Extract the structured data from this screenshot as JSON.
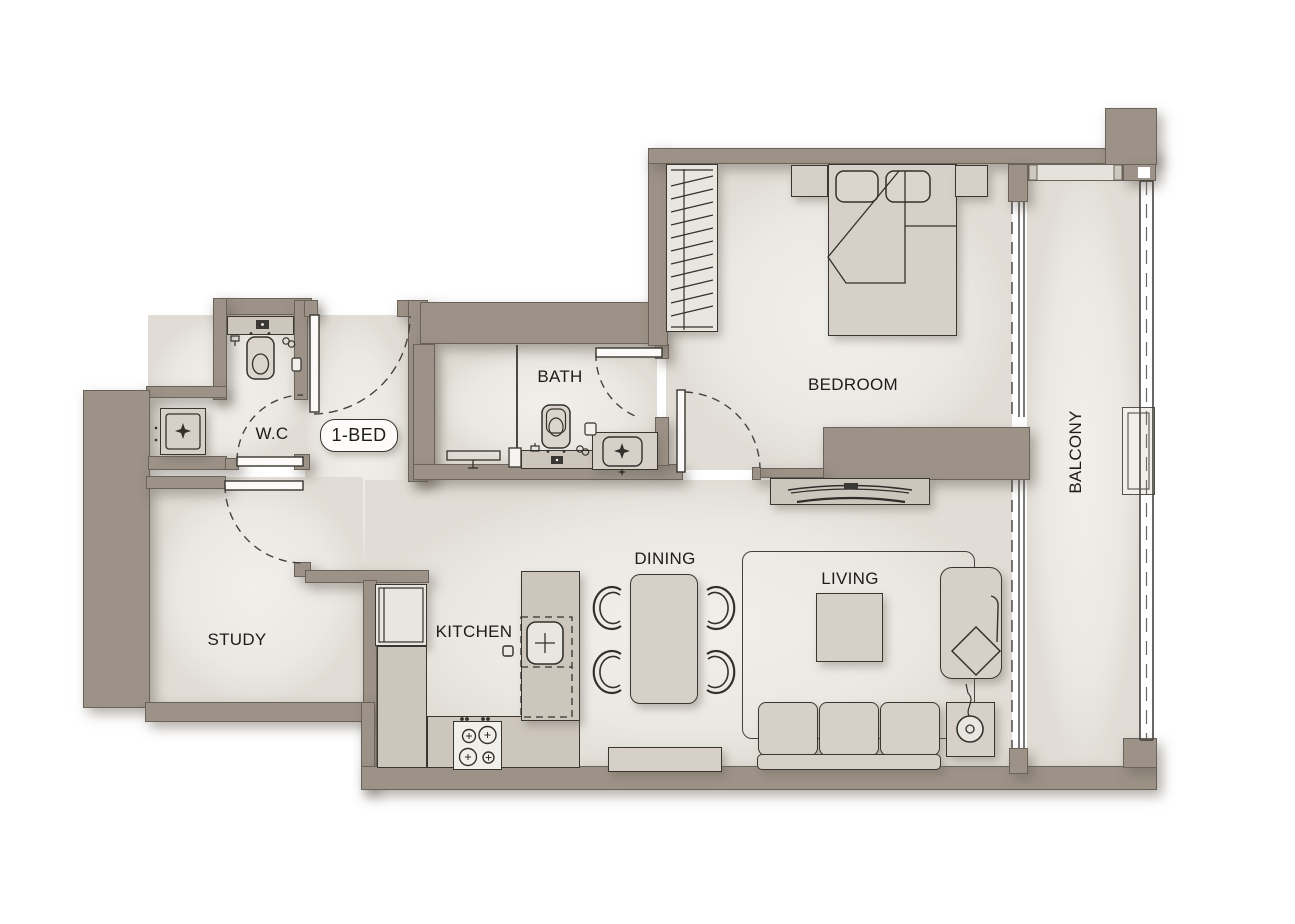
{
  "unit": {
    "label": "1-BED"
  },
  "rooms": {
    "wc": {
      "label": "W.C"
    },
    "bath": {
      "label": "BATH"
    },
    "bedroom": {
      "label": "BEDROOM"
    },
    "balcony": {
      "label": "BALCONY"
    },
    "study": {
      "label": "STUDY"
    },
    "kitchen": {
      "label": "KITCHEN"
    },
    "dining": {
      "label": "DINING"
    },
    "living": {
      "label": "LIVING"
    }
  },
  "colors": {
    "wall": "#9c9287",
    "wall_outline": "#6a635a",
    "floor": "#ebe8e3",
    "furniture": "#d6d0c8",
    "counter": "#cdc6bd",
    "outline": "#39362f",
    "background": "#ffffff",
    "text": "#1d1c1a"
  },
  "furniture_icons": [
    "double-bed",
    "pillow",
    "blanket-fold",
    "wardrobe-hangers",
    "nightstand",
    "tv-wall",
    "tv-console",
    "toilet",
    "washbasin",
    "vanity-counter",
    "shower-head",
    "shower-glass",
    "washing-machine-basin",
    "fridge",
    "kitchen-sink",
    "stove-burners",
    "kitchen-counter",
    "dining-table",
    "dining-chair",
    "rug",
    "coffee-table",
    "sofa",
    "side-table",
    "floor-lamp",
    "armchair",
    "cushion",
    "balcony-planter",
    "sliding-window",
    "railing",
    "door-swing"
  ]
}
